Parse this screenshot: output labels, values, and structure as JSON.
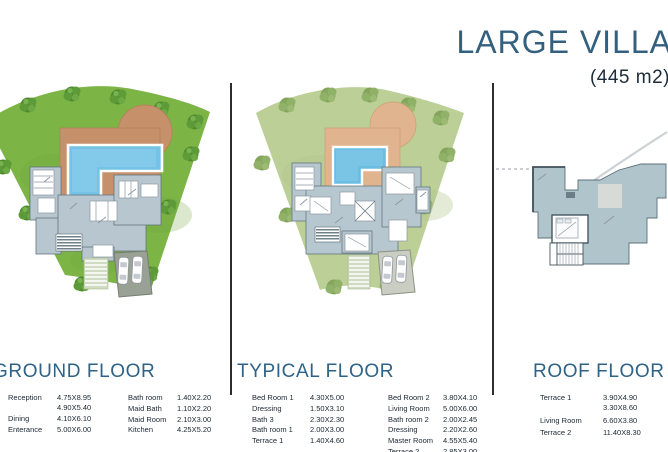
{
  "page": {
    "title": "LARGE VILLA",
    "area": "(445 m2)"
  },
  "colors": {
    "accent": "#33607f",
    "heading": "#2e6286",
    "table_text": "#1b2733",
    "lawn_ground": "#7db446",
    "lawn_typical": "#bccf97",
    "deck_ground": "#c6916a",
    "deck_typical": "#e0b48f",
    "pool": "#74c3e6",
    "building": "#b7c6cf",
    "divider": "#2d2d2d"
  },
  "sections": [
    {
      "id": "ground",
      "heading": "GROUND FLOOR",
      "rows_left": [
        {
          "label": "Reception",
          "dims": [
            "4.75X8.95",
            "4.90X5.40"
          ]
        },
        {
          "label": "Dining",
          "dims": [
            "4.10X6.10"
          ]
        },
        {
          "label": "Enterance",
          "dims": [
            "5.00X6.00"
          ]
        }
      ],
      "rows_right": [
        {
          "label": "Bath room",
          "dims": [
            "1.40X2.20"
          ]
        },
        {
          "label": "Maid Bath",
          "dims": [
            "1.10X2.20"
          ]
        },
        {
          "label": "Maid Room",
          "dims": [
            "2.10X3.00"
          ]
        },
        {
          "label": "Kitchen",
          "dims": [
            "4.25X5.20"
          ]
        }
      ]
    },
    {
      "id": "typical",
      "heading": "TYPICAL FLOOR",
      "rows_left": [
        {
          "label": "Bed Room 1",
          "dims": [
            "4.30X5.00"
          ]
        },
        {
          "label": "Dressing",
          "dims": [
            "1.50X3.10"
          ]
        },
        {
          "label": "Bath 3",
          "dims": [
            "2.30X2.30"
          ]
        },
        {
          "label": "Bath room 1",
          "dims": [
            "2.00X3.00"
          ]
        },
        {
          "label": "Terrace 1",
          "dims": [
            "1.40X4.60"
          ]
        }
      ],
      "rows_right": [
        {
          "label": "Bed Room 2",
          "dims": [
            "3.80X4.10"
          ]
        },
        {
          "label": "Living Room",
          "dims": [
            "5.00X6.00"
          ]
        },
        {
          "label": "Bath room 2",
          "dims": [
            "2.00X2.45"
          ]
        },
        {
          "label": "Dressing",
          "dims": [
            "2.20X2.60"
          ]
        },
        {
          "label": "Master Room",
          "dims": [
            "4.55X5.40"
          ]
        },
        {
          "label": "Terrace 2",
          "dims": [
            "2.85X3.00"
          ]
        }
      ]
    },
    {
      "id": "roof",
      "heading": "ROOF FLOOR",
      "rows_left": [
        {
          "label": "Terrace 1",
          "dims": [
            "3.90X4.90",
            "3.30X8.60"
          ]
        },
        {
          "label": "Living Room",
          "dims": [
            "6.60X3.80"
          ]
        },
        {
          "label": "Terrace 2",
          "dims": [
            "11.40X8.30"
          ]
        }
      ],
      "rows_right": []
    }
  ]
}
